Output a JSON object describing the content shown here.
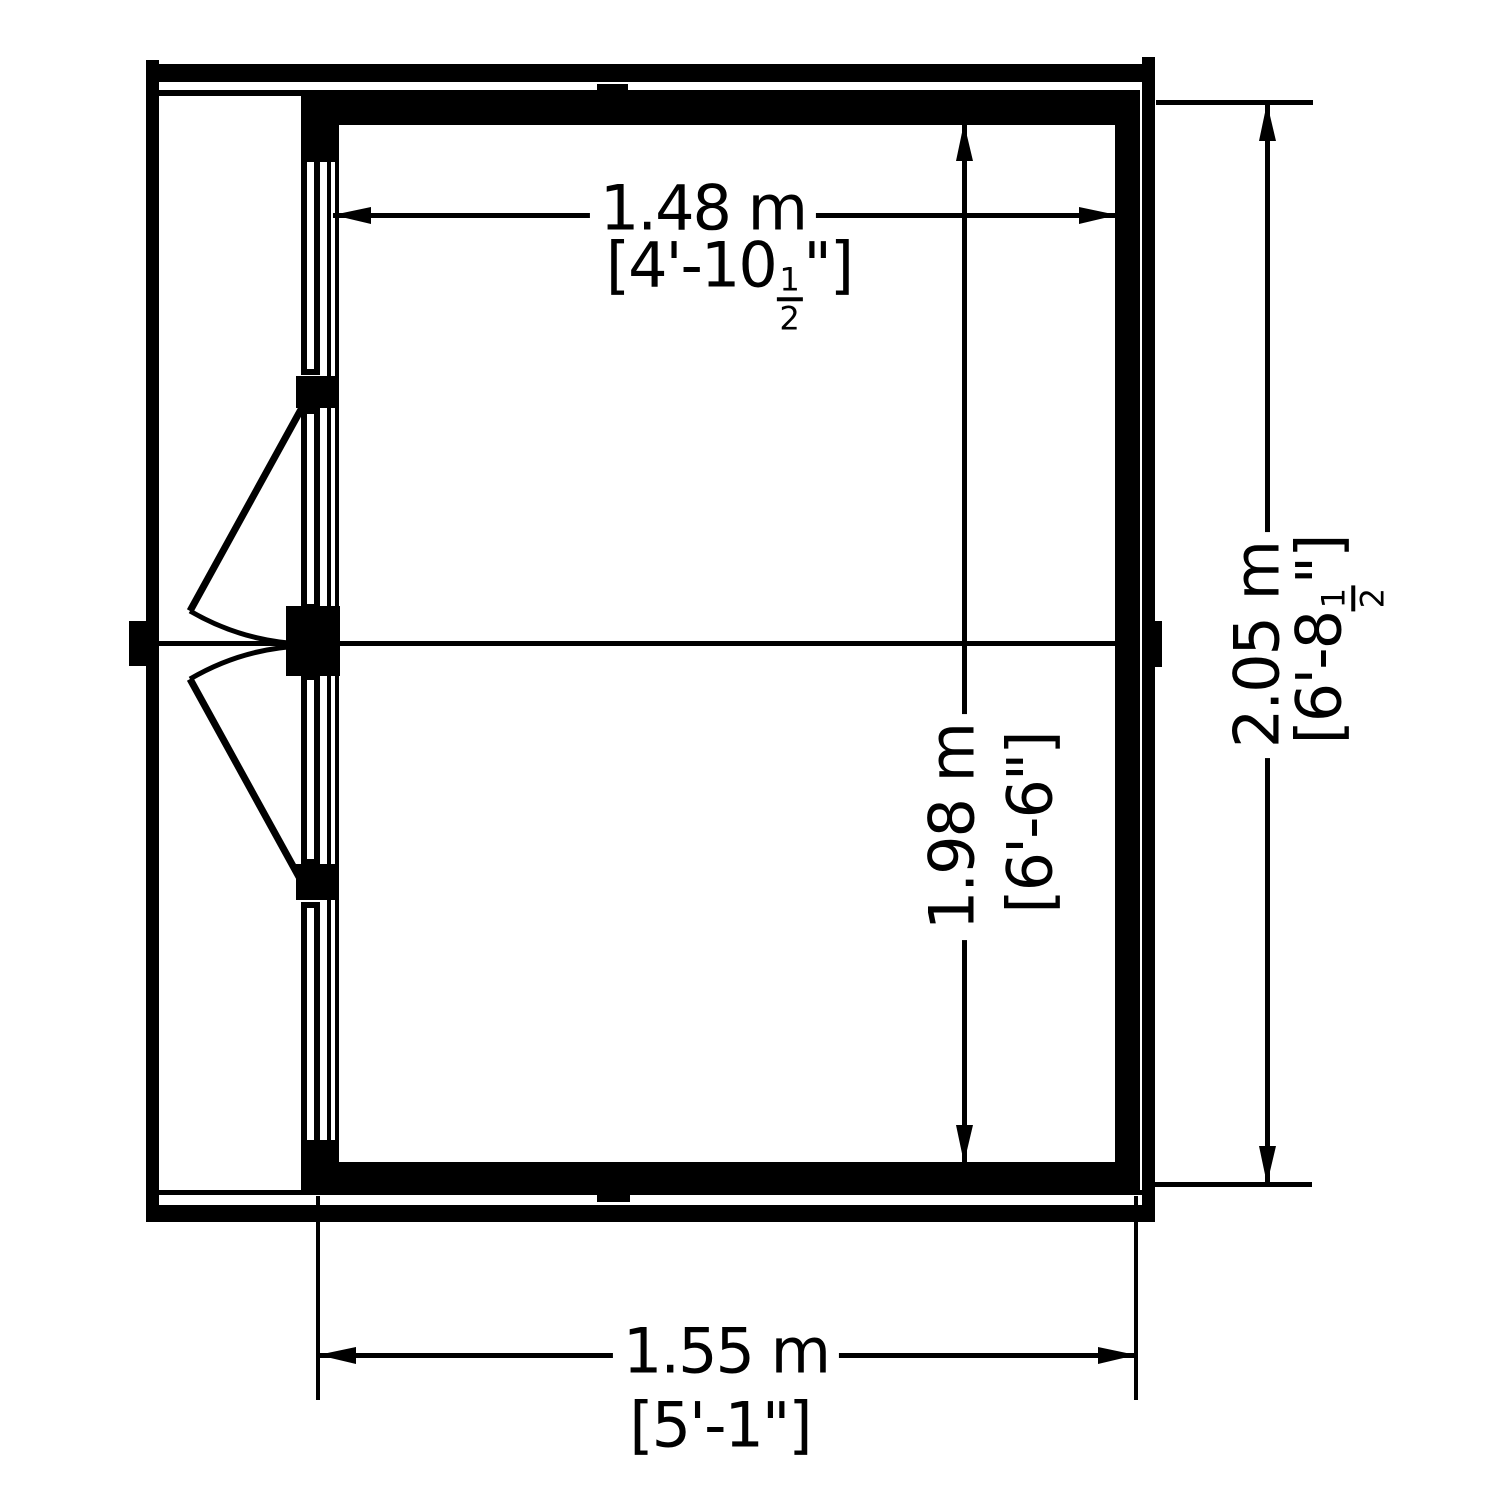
{
  "page": {
    "background": "#ffffff",
    "line_color": "#000000"
  },
  "dimensions": {
    "inner_width": {
      "metric": "1.48 m",
      "imperial_prefix": "[4'-10",
      "fraction_numerator": "1",
      "fraction_denominator": "2",
      "imperial_suffix": "\"]"
    },
    "inner_depth": {
      "metric": "1.98 m",
      "imperial": "[6'-6\"]"
    },
    "outer_depth": {
      "metric": "2.05 m",
      "imperial_prefix": "[6'-8",
      "fraction_numerator": "1",
      "fraction_denominator": "2",
      "imperial_suffix": "\"]"
    },
    "outer_width": {
      "metric": "1.55 m",
      "imperial": "[5'-1\"]"
    }
  }
}
